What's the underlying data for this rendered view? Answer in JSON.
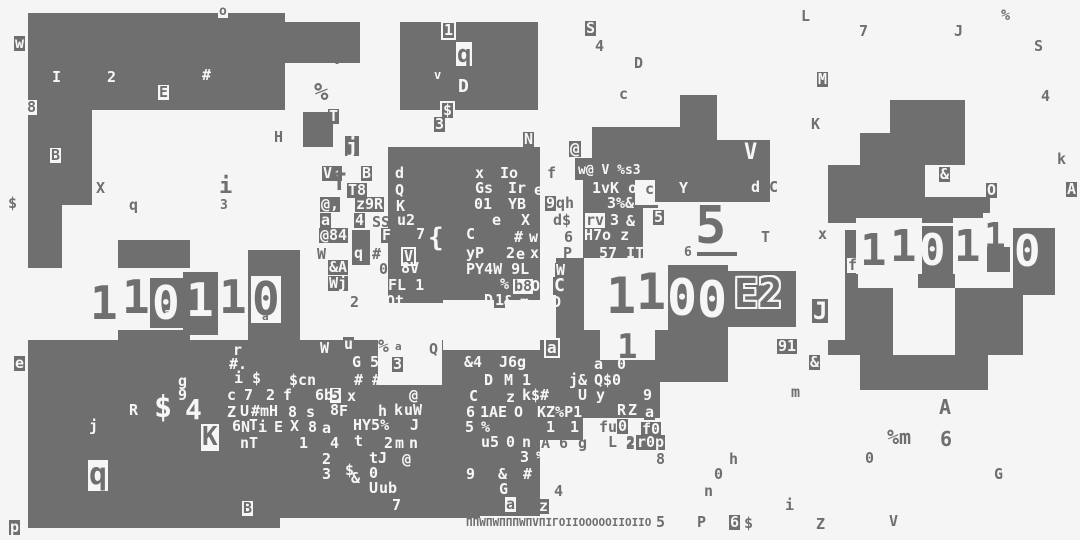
{
  "meta": {
    "title": "glitch-glyph-field",
    "width": 1080,
    "height": 540,
    "background_color": "#f5f5f5",
    "ink_color": "#6f6f6f",
    "paper_color": "#f6f6f6",
    "big_numbers": [
      "11011 0",
      "1100",
      "5",
      "110110",
      "E2"
    ]
  },
  "blocks": [
    [
      28,
      13,
      257,
      97
    ],
    [
      283,
      22,
      77,
      41
    ],
    [
      28,
      110,
      64,
      95
    ],
    [
      28,
      205,
      34,
      63
    ],
    [
      118,
      240,
      72,
      28
    ],
    [
      150,
      278,
      35,
      50
    ],
    [
      183,
      272,
      35,
      63
    ],
    [
      248,
      250,
      52,
      95
    ],
    [
      118,
      330,
      72,
      12
    ],
    [
      28,
      340,
      452,
      178
    ],
    [
      28,
      518,
      252,
      10
    ],
    [
      480,
      340,
      60,
      176
    ],
    [
      540,
      340,
      43,
      100
    ],
    [
      400,
      22,
      138,
      88
    ],
    [
      303,
      112,
      30,
      35
    ],
    [
      388,
      147,
      152,
      33
    ],
    [
      388,
      180,
      152,
      123
    ],
    [
      352,
      230,
      18,
      35
    ],
    [
      592,
      127,
      125,
      53
    ],
    [
      575,
      158,
      20,
      22
    ],
    [
      655,
      180,
      62,
      22
    ],
    [
      680,
      95,
      37,
      32
    ],
    [
      715,
      140,
      55,
      62
    ],
    [
      583,
      180,
      52,
      78
    ],
    [
      633,
      205,
      25,
      53
    ],
    [
      556,
      258,
      28,
      104
    ],
    [
      668,
      265,
      60,
      65
    ],
    [
      728,
      271,
      68,
      56
    ],
    [
      583,
      330,
      17,
      50
    ],
    [
      655,
      330,
      73,
      52
    ],
    [
      556,
      360,
      104,
      58
    ],
    [
      697,
      252,
      40,
      4
    ],
    [
      890,
      100,
      75,
      33
    ],
    [
      860,
      133,
      105,
      32
    ],
    [
      828,
      165,
      97,
      58
    ],
    [
      925,
      197,
      65,
      26
    ],
    [
      985,
      245,
      25,
      27
    ],
    [
      845,
      230,
      13,
      110
    ],
    [
      918,
      226,
      37,
      62
    ],
    [
      1013,
      228,
      42,
      67
    ],
    [
      858,
      288,
      35,
      67
    ],
    [
      955,
      288,
      68,
      67
    ],
    [
      828,
      340,
      65,
      15
    ],
    [
      955,
      340,
      65,
      15
    ],
    [
      860,
      355,
      128,
      35
    ]
  ],
  "holes": [
    [
      348,
      293,
      30,
      37
    ],
    [
      443,
      300,
      97,
      50
    ],
    [
      378,
      332,
      64,
      53
    ],
    [
      643,
      208,
      52,
      52
    ],
    [
      856,
      218,
      66,
      56
    ],
    [
      953,
      218,
      34,
      56
    ],
    [
      983,
      213,
      28,
      34
    ]
  ],
  "glyphs": [
    [
      "o",
      218,
      5,
      "c",
      13
    ],
    [
      "w",
      14,
      36,
      "b"
    ],
    [
      "I",
      52,
      70,
      "w"
    ],
    [
      "2",
      107,
      70,
      "w"
    ],
    [
      "#",
      202,
      68,
      "w"
    ],
    [
      "E",
      158,
      85,
      "c"
    ],
    [
      "8",
      26,
      100,
      "c"
    ],
    [
      "B",
      50,
      148,
      "c"
    ],
    [
      "$",
      8,
      196,
      "g"
    ],
    [
      "X",
      96,
      181,
      "g"
    ],
    [
      "q",
      129,
      198,
      "g"
    ],
    [
      "i",
      219,
      176,
      "g",
      22
    ],
    [
      "3",
      220,
      199,
      "g",
      13
    ],
    [
      "Y",
      331,
      47,
      "g",
      20
    ],
    [
      "%",
      314,
      80,
      "g",
      24
    ],
    [
      "T",
      328,
      109,
      "b"
    ],
    [
      "H",
      274,
      130,
      "g"
    ],
    [
      "1",
      441,
      21,
      "x"
    ],
    [
      "q",
      456,
      42,
      "c",
      24
    ],
    [
      "v",
      434,
      69,
      "w",
      12
    ],
    [
      "D",
      458,
      78,
      "w",
      18
    ],
    [
      "$",
      440,
      101,
      "x"
    ],
    [
      "3",
      434,
      117,
      "b"
    ],
    [
      "N",
      523,
      132,
      "b"
    ],
    [
      "S",
      585,
      21,
      "b"
    ],
    [
      "4",
      595,
      39,
      "g"
    ],
    [
      "D",
      634,
      56,
      "g"
    ],
    [
      "c",
      619,
      87,
      "g"
    ],
    [
      "L",
      801,
      9,
      "g"
    ],
    [
      "7",
      859,
      24,
      "g"
    ],
    [
      "J",
      954,
      24,
      "g"
    ],
    [
      "%",
      1001,
      8,
      "g"
    ],
    [
      "S",
      1034,
      39,
      "g"
    ],
    [
      "M",
      817,
      72,
      "b"
    ],
    [
      "4",
      1041,
      89,
      "g"
    ],
    [
      "K",
      811,
      117,
      "g"
    ],
    [
      "k",
      1057,
      152,
      "g"
    ],
    [
      "&",
      939,
      167,
      "b"
    ],
    [
      "O",
      986,
      183,
      "b"
    ],
    [
      "A",
      1066,
      182,
      "b"
    ],
    [
      "j",
      345,
      136,
      "b",
      20
    ],
    [
      "V‹",
      322,
      166,
      "b"
    ],
    [
      "B",
      361,
      166,
      "b"
    ],
    [
      "T",
      332,
      170,
      "g",
      24
    ],
    [
      "T8",
      347,
      183,
      "b"
    ],
    [
      "d",
      395,
      166,
      "w"
    ],
    [
      "Q",
      395,
      183,
      "w"
    ],
    [
      "K",
      395,
      199,
      "b"
    ],
    [
      "x",
      474,
      166,
      "b"
    ],
    [
      "Io",
      500,
      166,
      "w"
    ],
    [
      "f",
      547,
      166,
      "g"
    ],
    [
      "@,",
      320,
      197,
      "b"
    ],
    [
      "z9R",
      355,
      197,
      "b"
    ],
    [
      "Gs",
      474,
      181,
      "b"
    ],
    [
      "Ir",
      508,
      181,
      "w"
    ],
    [
      "e",
      534,
      183,
      "w"
    ],
    [
      "N",
      562,
      183,
      "w"
    ],
    [
      "01",
      474,
      197,
      "w"
    ],
    [
      "YB",
      508,
      197,
      "w"
    ],
    [
      "9",
      545,
      196,
      "b"
    ],
    [
      "qh",
      556,
      196,
      "g"
    ],
    [
      "a",
      320,
      213,
      "b"
    ],
    [
      "4",
      354,
      213,
      "b"
    ],
    [
      "SS",
      372,
      215,
      "g"
    ],
    [
      "u2",
      397,
      213,
      "w"
    ],
    [
      "e",
      491,
      213,
      "b"
    ],
    [
      "X",
      521,
      213,
      "w"
    ],
    [
      "d$",
      553,
      213,
      "g"
    ],
    [
      "@84",
      319,
      228,
      "b"
    ],
    [
      "F",
      381,
      228,
      "b"
    ],
    [
      "7",
      416,
      227,
      "w"
    ],
    [
      "{",
      428,
      225,
      "w",
      26
    ],
    [
      "C",
      466,
      227,
      "w"
    ],
    [
      "#",
      514,
      230,
      "w"
    ],
    [
      "w",
      529,
      230,
      "w"
    ],
    [
      "6",
      564,
      230,
      "g"
    ],
    [
      "rv",
      585,
      213,
      "c"
    ],
    [
      "3",
      610,
      213,
      "w"
    ],
    [
      "&",
      626,
      214,
      "w"
    ],
    [
      "5",
      653,
      210,
      "b"
    ],
    [
      "W",
      317,
      247,
      "g"
    ],
    [
      "q",
      354,
      246,
      "w"
    ],
    [
      "#",
      372,
      247,
      "g"
    ],
    [
      "V",
      401,
      247,
      "x"
    ],
    [
      "yP",
      466,
      246,
      "w"
    ],
    [
      "2",
      506,
      246,
      "w"
    ],
    [
      "e",
      515,
      247,
      "b"
    ],
    [
      "x",
      529,
      246,
      "b"
    ],
    [
      "E",
      540,
      245,
      "w"
    ],
    [
      "H7o z",
      584,
      228,
      "w"
    ],
    [
      "P",
      563,
      246,
      "g"
    ],
    [
      "57 IT",
      599,
      246,
      "w"
    ],
    [
      "&A",
      328,
      260,
      "b"
    ],
    [
      "0",
      379,
      262,
      "g"
    ],
    [
      "8V",
      401,
      261,
      "w"
    ],
    [
      "PY4W 9L",
      466,
      262,
      "w"
    ],
    [
      "W",
      555,
      263,
      "b"
    ],
    [
      "Wj",
      328,
      276,
      "b"
    ],
    [
      "FL 1",
      388,
      278,
      "w"
    ],
    [
      "%",
      499,
      277,
      "b"
    ],
    [
      "b8",
      513,
      279,
      "c"
    ],
    [
      "Oji",
      531,
      279,
      "w"
    ],
    [
      "C",
      553,
      277,
      "b",
      18
    ],
    [
      "Qt",
      386,
      294,
      "w"
    ],
    [
      "2",
      350,
      295,
      "g"
    ],
    [
      "D",
      484,
      293,
      "w"
    ],
    [
      "1",
      494,
      293,
      "b"
    ],
    [
      "&",
      504,
      294,
      "w"
    ],
    [
      "m",
      520,
      295,
      "w"
    ],
    [
      "D",
      552,
      295,
      "w"
    ],
    [
      "w@ V %s3",
      578,
      164,
      "w",
      13
    ],
    [
      "1",
      591,
      181,
      "b"
    ],
    [
      "vK o4",
      601,
      181,
      "w"
    ],
    [
      "c",
      645,
      182,
      "g"
    ],
    [
      "Y",
      679,
      181,
      "w"
    ],
    [
      "3%&",
      607,
      196,
      "w"
    ],
    [
      "@",
      569,
      141,
      "b",
      16
    ],
    [
      "V",
      744,
      142,
      "w",
      22
    ],
    [
      "d",
      751,
      180,
      "w"
    ],
    [
      "C",
      769,
      180,
      "g"
    ],
    [
      "T",
      761,
      230,
      "g"
    ],
    [
      "6",
      684,
      246,
      "g",
      13
    ],
    [
      "5",
      695,
      200,
      "g",
      52
    ],
    [
      "1",
      90,
      280,
      "g",
      46
    ],
    [
      "1",
      122,
      274,
      "g",
      46
    ],
    [
      "0",
      152,
      280,
      "w",
      46
    ],
    [
      "1",
      186,
      277,
      "w",
      46
    ],
    [
      "1",
      219,
      274,
      "g",
      46
    ],
    [
      "0",
      251,
      276,
      "c",
      46
    ],
    [
      "a",
      164,
      307,
      "w",
      12
    ],
    [
      "a",
      262,
      311,
      "g",
      11
    ],
    [
      "1",
      606,
      271,
      "g",
      50
    ],
    [
      "1",
      636,
      267,
      "g",
      50
    ],
    [
      "0",
      667,
      273,
      "w",
      50
    ],
    [
      "0",
      697,
      275,
      "w",
      50
    ],
    [
      "E2",
      734,
      274,
      "o",
      40
    ],
    [
      "1",
      617,
      330,
      "g",
      34
    ],
    [
      "91",
      777,
      339,
      "b"
    ],
    [
      "a",
      544,
      338,
      "x",
      16
    ],
    [
      "a",
      594,
      357,
      "w"
    ],
    [
      "0",
      617,
      357,
      "w"
    ],
    [
      "1",
      860,
      229,
      "g",
      44
    ],
    [
      "1",
      890,
      225,
      "g",
      44
    ],
    [
      "0",
      919,
      229,
      "w",
      44
    ],
    [
      "1",
      954,
      225,
      "g",
      44
    ],
    [
      "1",
      984,
      219,
      "g",
      36
    ],
    [
      "0",
      1014,
      230,
      "w",
      44
    ],
    [
      "x",
      818,
      227,
      "g"
    ],
    [
      "f",
      847,
      258,
      "c"
    ],
    [
      "J",
      812,
      299,
      "b",
      24
    ],
    [
      "&",
      809,
      355,
      "b"
    ],
    [
      "m",
      791,
      385,
      "g"
    ],
    [
      "A",
      939,
      397,
      "g",
      20
    ],
    [
      "%m",
      887,
      427,
      "g",
      20
    ],
    [
      "6",
      940,
      429,
      "g",
      20
    ],
    [
      "0",
      864,
      451,
      "c"
    ],
    [
      "G",
      993,
      467,
      "c"
    ],
    [
      "Z",
      816,
      517,
      "g"
    ],
    [
      "V",
      889,
      514,
      "g"
    ],
    [
      "e",
      14,
      356,
      "b"
    ],
    [
      "r",
      233,
      343,
      "w"
    ],
    [
      "#.",
      228,
      357,
      "b"
    ],
    [
      "i $",
      234,
      371,
      "w"
    ],
    [
      "g",
      178,
      374,
      "w"
    ],
    [
      "9",
      178,
      388,
      "w"
    ],
    [
      "$cn",
      288,
      373,
      "b"
    ],
    [
      "c",
      227,
      388,
      "w"
    ],
    [
      "7",
      244,
      388,
      "w"
    ],
    [
      "2",
      266,
      388,
      "w"
    ],
    [
      "f",
      283,
      388,
      "w"
    ],
    [
      "6b",
      315,
      388,
      "w"
    ],
    [
      "5",
      330,
      388,
      "c"
    ],
    [
      "x",
      347,
      389,
      "w"
    ],
    [
      "@",
      408,
      388,
      "b"
    ],
    [
      "C",
      469,
      389,
      "w"
    ],
    [
      "R",
      129,
      403,
      "w"
    ],
    [
      "$",
      154,
      393,
      "w",
      30
    ],
    [
      "4",
      185,
      396,
      "w",
      28
    ],
    [
      "Z",
      227,
      405,
      "w"
    ],
    [
      "U",
      239,
      404,
      "b"
    ],
    [
      "#mH",
      251,
      404,
      "w"
    ],
    [
      "8",
      288,
      405,
      "w"
    ],
    [
      "s",
      306,
      405,
      "w"
    ],
    [
      "8",
      329,
      403,
      "b"
    ],
    [
      "F",
      339,
      404,
      "w"
    ],
    [
      "h",
      378,
      404,
      "w"
    ],
    [
      "k",
      393,
      403,
      "b"
    ],
    [
      "uW",
      404,
      403,
      "w"
    ],
    [
      "6",
      465,
      405,
      "b"
    ],
    [
      "j",
      89,
      419,
      "w"
    ],
    [
      "6",
      232,
      419,
      "w"
    ],
    [
      "N",
      240,
      420,
      "b"
    ],
    [
      "T",
      249,
      418,
      "w"
    ],
    [
      "i",
      257,
      420,
      "b"
    ],
    [
      "E",
      273,
      420,
      "b"
    ],
    [
      "X",
      290,
      419,
      "w"
    ],
    [
      "8",
      307,
      420,
      "b"
    ],
    [
      "a",
      322,
      421,
      "w"
    ],
    [
      "HY5%",
      353,
      418,
      "w"
    ],
    [
      "J",
      409,
      418,
      "b"
    ],
    [
      "K",
      201,
      424,
      "c",
      26
    ],
    [
      "q",
      88,
      460,
      "c",
      30
    ],
    [
      "nT",
      239,
      436,
      "b"
    ],
    [
      "1",
      299,
      436,
      "w"
    ],
    [
      "4",
      330,
      436,
      "w"
    ],
    [
      "t",
      353,
      434,
      "b"
    ],
    [
      "2",
      384,
      436,
      "w"
    ],
    [
      "m",
      394,
      436,
      "b"
    ],
    [
      "n",
      409,
      436,
      "w"
    ],
    [
      "2",
      321,
      452,
      "b"
    ],
    [
      "tJ",
      369,
      451,
      "w"
    ],
    [
      "@",
      401,
      452,
      "b"
    ],
    [
      "3",
      321,
      467,
      "b"
    ],
    [
      "$",
      345,
      463,
      "w"
    ],
    [
      "&",
      351,
      471,
      "w"
    ],
    [
      "0",
      369,
      466,
      "w"
    ],
    [
      "U",
      368,
      481,
      "b"
    ],
    [
      "ub",
      379,
      481,
      "w"
    ],
    [
      "7",
      392,
      498,
      "w"
    ],
    [
      "B",
      242,
      501,
      "c"
    ],
    [
      "p",
      9,
      520,
      "b"
    ],
    [
      "W",
      320,
      341,
      "w"
    ],
    [
      "u",
      343,
      337,
      "b"
    ],
    [
      "%",
      378,
      338,
      "g",
      18
    ],
    [
      "a",
      395,
      341,
      "g",
      11
    ],
    [
      "Q",
      429,
      342,
      "g"
    ],
    [
      "G 5",
      352,
      355,
      "w"
    ],
    [
      "3",
      392,
      357,
      "b"
    ],
    [
      "# #",
      354,
      373,
      "w"
    ],
    [
      "&4",
      463,
      355,
      "b"
    ],
    [
      "J6g",
      499,
      355,
      "w"
    ],
    [
      "D",
      483,
      373,
      "b"
    ],
    [
      "M 1",
      504,
      373,
      "w"
    ],
    [
      "j&",
      569,
      373,
      "w"
    ],
    [
      "Q$0",
      594,
      373,
      "w"
    ],
    [
      "U y",
      578,
      388,
      "w"
    ],
    [
      "9",
      643,
      388,
      "w"
    ],
    [
      "z",
      506,
      390,
      "w"
    ],
    [
      "k",
      521,
      388,
      "b"
    ],
    [
      "$#",
      531,
      388,
      "w"
    ],
    [
      "1",
      479,
      405,
      "b"
    ],
    [
      "AE",
      489,
      405,
      "w"
    ],
    [
      "O",
      513,
      405,
      "b"
    ],
    [
      "KZ%P1",
      537,
      405,
      "w"
    ],
    [
      "R",
      617,
      403,
      "w"
    ],
    [
      "Z",
      627,
      403,
      "b"
    ],
    [
      "a",
      644,
      405,
      "b"
    ],
    [
      "5",
      464,
      420,
      "b"
    ],
    [
      "%",
      481,
      420,
      "w"
    ],
    [
      "1",
      546,
      420,
      "w"
    ],
    [
      "1",
      569,
      420,
      "b"
    ],
    [
      "fu",
      599,
      420,
      "g"
    ],
    [
      "0",
      617,
      419,
      "b"
    ],
    [
      "f0",
      641,
      422,
      "b"
    ],
    [
      "u5",
      481,
      435,
      "w"
    ],
    [
      "0",
      506,
      435,
      "w"
    ],
    [
      "n",
      521,
      435,
      "b"
    ],
    [
      "A 6",
      541,
      436,
      "g"
    ],
    [
      "g",
      578,
      436,
      "g"
    ],
    [
      "L 2",
      608,
      435,
      "g"
    ],
    [
      "2",
      626,
      437,
      "g"
    ],
    [
      "r0p",
      636,
      435,
      "b"
    ],
    [
      "3",
      519,
      450,
      "b"
    ],
    [
      "%",
      536,
      450,
      "w"
    ],
    [
      "9",
      465,
      467,
      "b"
    ],
    [
      "&",
      498,
      467,
      "w"
    ],
    [
      "#",
      523,
      467,
      "w"
    ],
    [
      "G",
      498,
      482,
      "b"
    ],
    [
      "4",
      554,
      484,
      "g"
    ],
    [
      "a",
      505,
      497,
      "c"
    ],
    [
      "z",
      538,
      499,
      "b"
    ],
    [
      "8",
      656,
      452,
      "g"
    ],
    [
      "h",
      729,
      452,
      "g"
    ],
    [
      "0",
      714,
      467,
      "g"
    ],
    [
      "n",
      704,
      484,
      "g"
    ],
    [
      "i",
      785,
      498,
      "g"
    ],
    [
      "5",
      656,
      515,
      "g"
    ],
    [
      "P",
      697,
      515,
      "g"
    ],
    [
      "6",
      729,
      515,
      "b"
    ],
    [
      "$",
      744,
      516,
      "g"
    ],
    [
      "ΠΠWΠWΠΠΠWΠVΠIΓOIIOOOOOIIOIIO",
      466,
      517,
      "g",
      11
    ]
  ]
}
